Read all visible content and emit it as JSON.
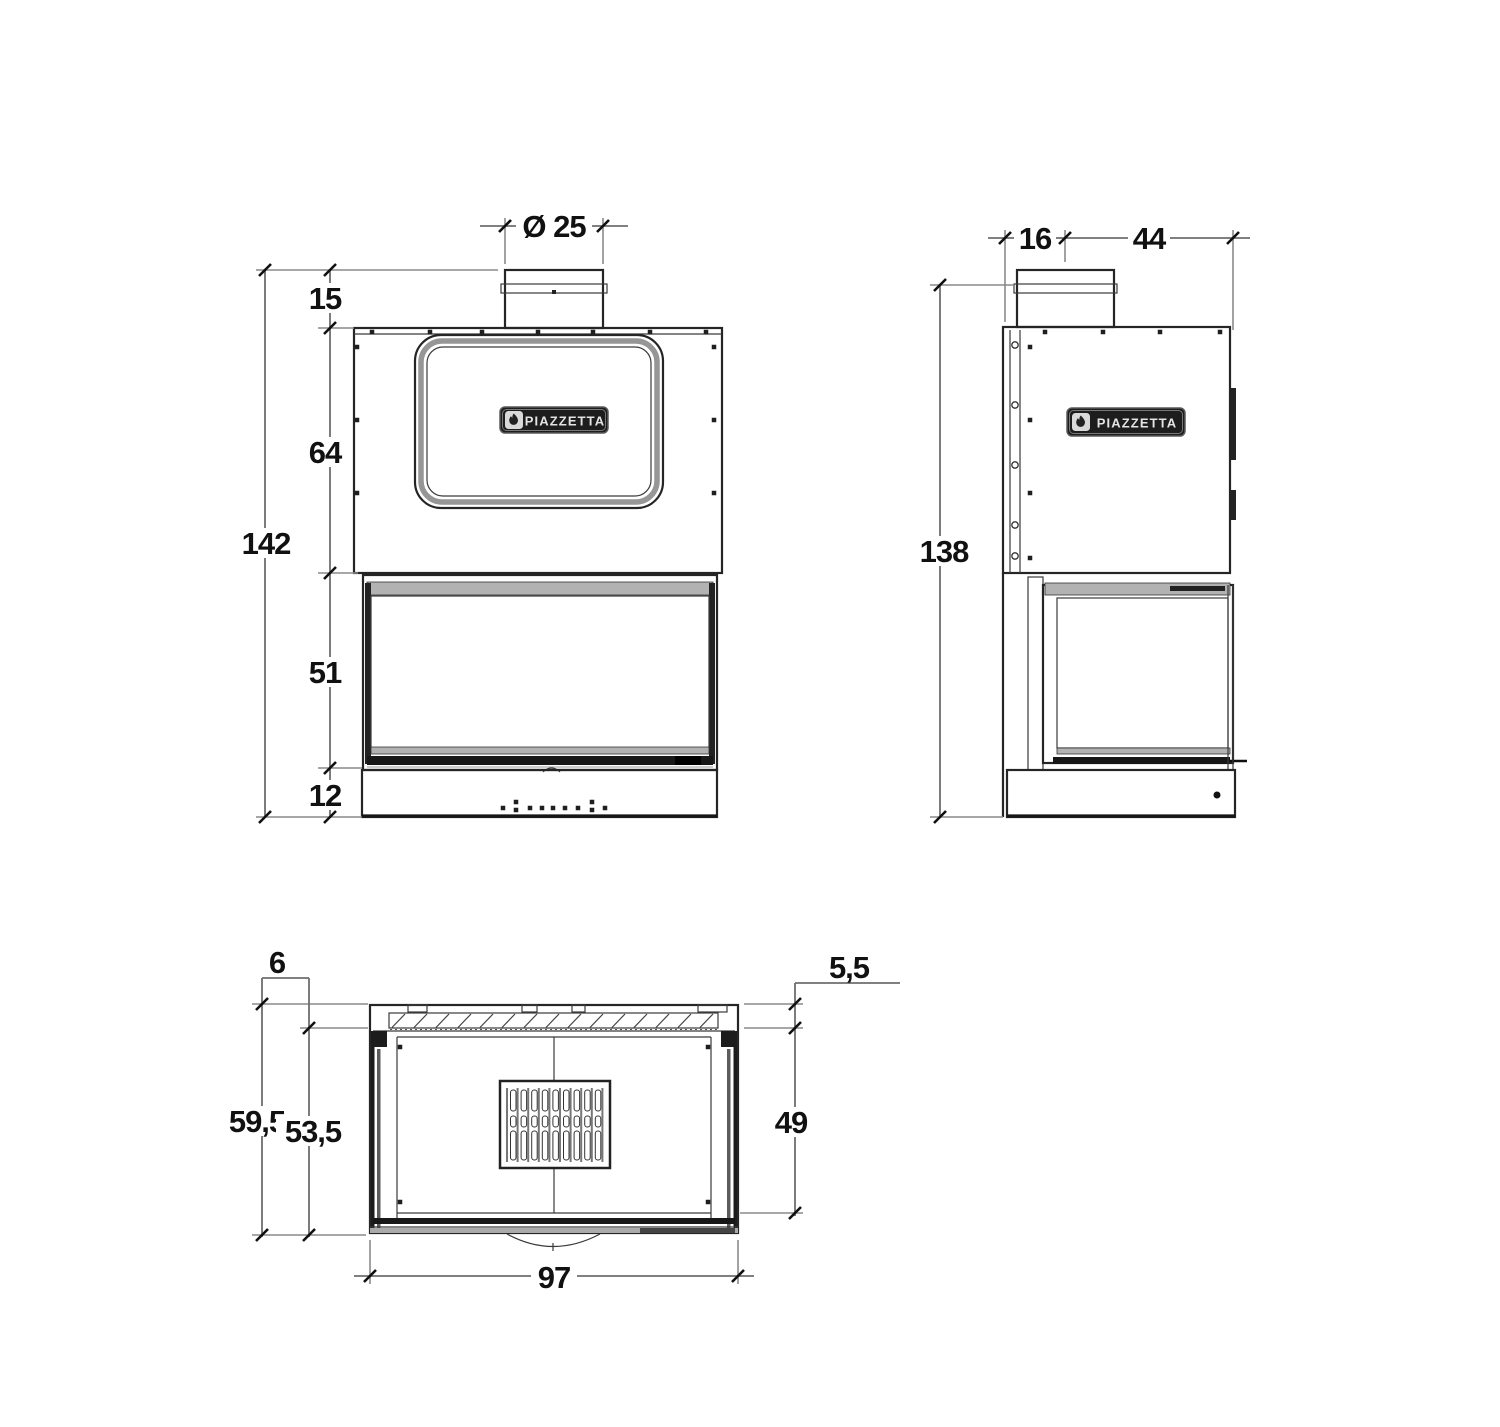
{
  "drawing": {
    "brand_badge": "PIAZZETTA",
    "views": {
      "front": {
        "dims": {
          "flue_diameter": "Ø 25",
          "flue_stub_height": "15",
          "upper_body_height": "64",
          "firebox_height": "51",
          "base_height": "12",
          "total_height": "142"
        }
      },
      "side": {
        "dims": {
          "back_to_flue_center": "16",
          "flue_center_to_front": "44",
          "total_height": "138"
        }
      },
      "plan": {
        "dims": {
          "rear_gap_left": "6",
          "rear_gap_right": "5,5",
          "total_depth": "59,5",
          "inner_depth": "53,5",
          "chamber_depth": "49",
          "total_width": "97"
        }
      }
    }
  }
}
